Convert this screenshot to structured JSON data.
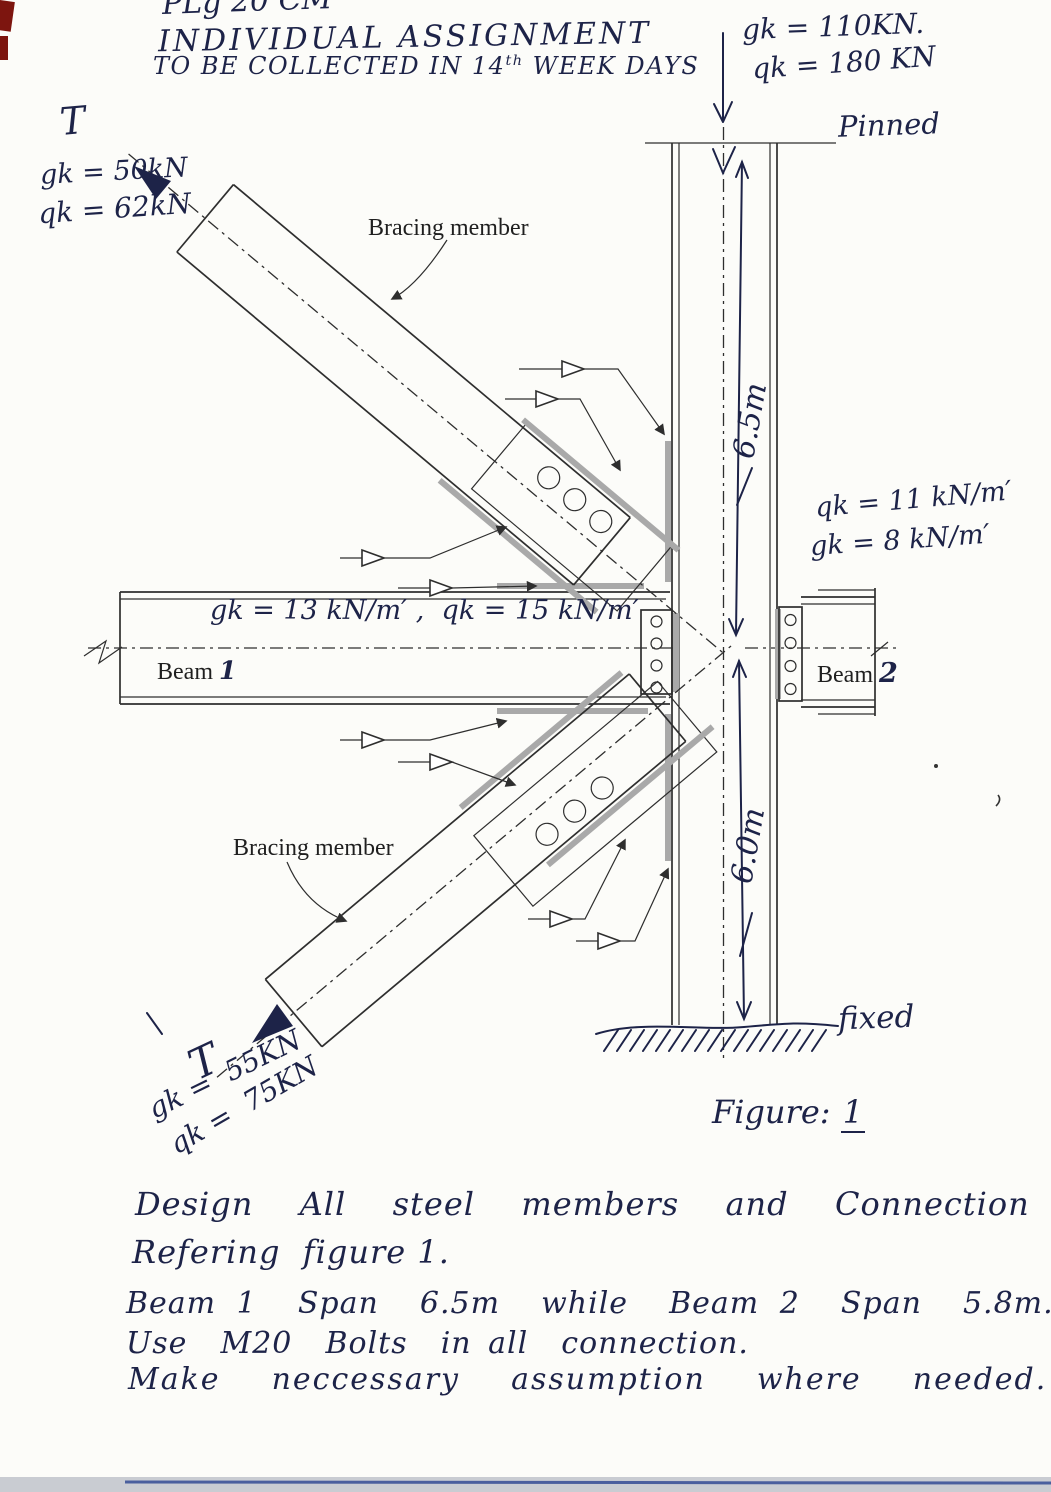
{
  "colors": {
    "ink_blue": "#1d2348",
    "drawing_black": "#2e2e2e",
    "weld_gray": "#a9a9a9",
    "scan_band_gray": "#c9ccd2",
    "red_edge_mark": "#7d150f"
  },
  "header": {
    "line1": "PLg 20 CM",
    "line2": "INDIVIDUAL ASSIGNMENT",
    "line3_pre": "TO BE COLLECTED IN 14",
    "line3_sup": "th",
    "line3_post": " WEEK DAYS"
  },
  "supports": {
    "top": "Pinned",
    "bottom": "fixed"
  },
  "dimensions": {
    "upper_column": "6.5m",
    "lower_column": "6.0m"
  },
  "loads": {
    "column_top_1": "gk = 110KN.",
    "column_top_2": "qk = 180 KN",
    "beam1": "gk = 13 kN/m′ ,  qk = 15 kN/m′",
    "beam2_1": "qk = 11 kN/m′",
    "beam2_2": "gk = 8 kN/m′",
    "brace_upper_t": "T",
    "brace_upper_1": "gk = 50kN",
    "brace_upper_2": "qk = 62kN",
    "brace_lower_t": "T",
    "brace_lower_1": "gk =  55KN",
    "brace_lower_2": "qk =  75KN"
  },
  "labels": {
    "bracing_upper": "Bracing member",
    "bracing_lower": "Bracing member",
    "beam1_name": "Beam",
    "beam1_no": "1",
    "beam2_name": "Beam",
    "beam2_no": "2"
  },
  "caption": {
    "pre": "Figure: ",
    "no": "1"
  },
  "notes": {
    "line1": "Design  All  steel  members  and  Connection",
    "line2": "Refering  figure 1.",
    "line3": "Beam 1  Span  6.5m  while  Beam 2  Span  5.8m.",
    "line4": "Use  M20  Bolts  in all  connection.",
    "line5": "Make  neccessary  assumption  where  needed."
  }
}
